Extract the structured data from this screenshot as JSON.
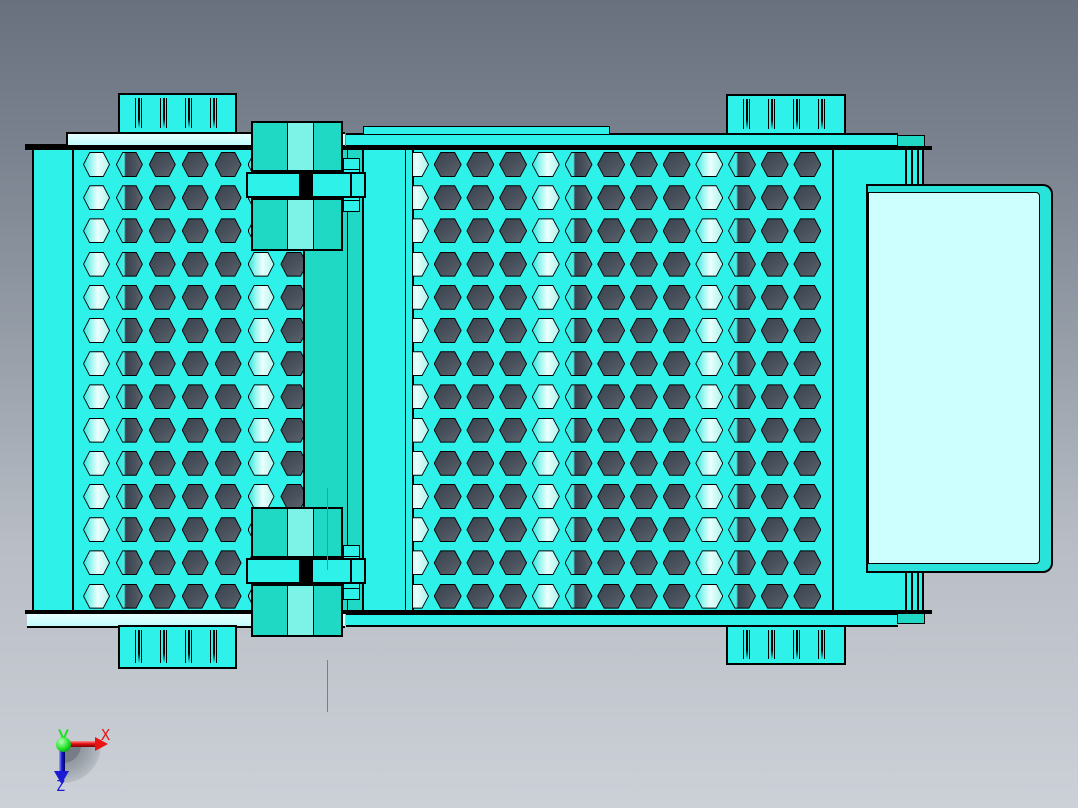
{
  "scene": {
    "view": "top",
    "model": "vibrating-screen-assembly"
  },
  "axis_triad": {
    "x_label": "X",
    "z_label": "Z"
  },
  "colors": {
    "bg_top": "#68717d",
    "bg_mid": "#9aa1ab",
    "bg_bottom": "#ccd0d7",
    "cyan": "#2ef2ea",
    "teal": "#1fd9c5",
    "teal_light": "#7df3e7",
    "pale": "#c2fcfd",
    "panel_light": "#cdffff",
    "panel_edge": "#29e2da",
    "hex_dark_a": "#39424e",
    "hex_dark_b": "#4a525d",
    "hex_dark_c": "#5d646e",
    "hex_light_a": "#35e8e0",
    "hex_light_b": "#9cf6f0",
    "hex_light_c": "#eafffd",
    "hex_light_d": "#b0f3ed",
    "hex_half_a": "#2ce9e1",
    "hex_half_b": "#4aeee6",
    "centerline": "#7a7f85",
    "axis_x": "#e81313",
    "axis_z": "#1b1bd6",
    "axis_origin": "#1ddf25"
  },
  "plates": {
    "left": {
      "rows": 14,
      "cols": 7,
      "origin_x": 11,
      "origin_y": 4,
      "pitch_x": 32.9,
      "pitch_y": 33.2,
      "hex_w": 27,
      "hex_h": 25,
      "col_shading": [
        "light",
        "half",
        "dark",
        "dark",
        "dark",
        "light",
        "dark"
      ]
    },
    "right": {
      "rows": 14,
      "cols": 13,
      "origin_x": -12,
      "origin_y": 4,
      "pitch_x": 32.7,
      "pitch_y": 33.2,
      "hex_w": 28,
      "hex_h": 25,
      "col_shading": [
        "light",
        "dark",
        "dark",
        "dark",
        "light",
        "half",
        "dark",
        "dark",
        "dark",
        "light",
        "half",
        "dark",
        "dark"
      ]
    }
  },
  "springs": {
    "packs": 4,
    "slits_per_pack": 4,
    "slit_offsets": [
      15,
      40,
      65,
      90
    ]
  }
}
